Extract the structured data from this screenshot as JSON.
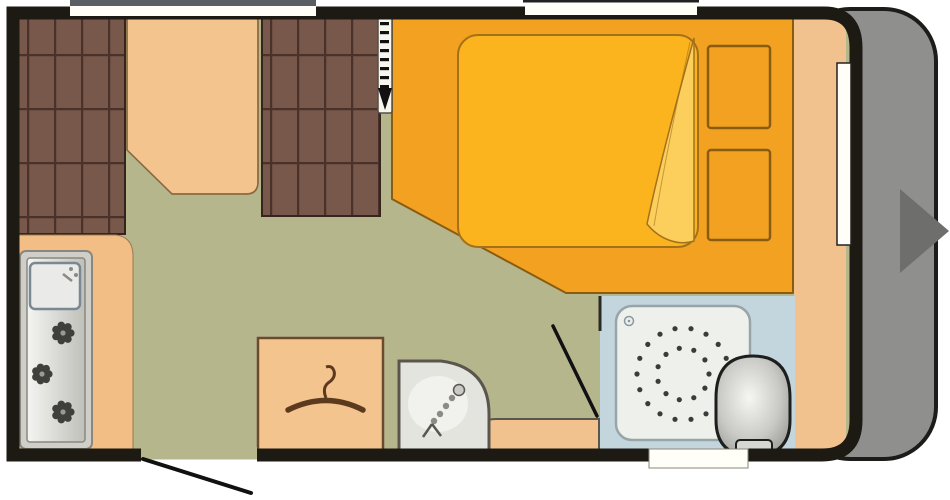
{
  "title": "Caravan floor plan (top view)",
  "fixtures": [
    "left bench seat",
    "dining table",
    "right bench seat",
    "sliding divider with arrow",
    "kitchen unit with sink and 3-burner hob",
    "double bed with folded duvet",
    "overbed storage shelves",
    "wardrobe with clothes hanger",
    "corner washbasin",
    "bathroom with shower tray and toilet",
    "entrance door with swing",
    "windows",
    "front end cap with towing direction arrow"
  ],
  "colors": {
    "page_bg": "#ffffff",
    "wall": "#1d1a14",
    "floor": "#b6b68d",
    "seat_cushion": "#77584a",
    "seat_grid": "#4a322a",
    "seat_outline": "#35251e",
    "table": "#f4c48f",
    "table_outline": "#8a6a42",
    "kitchen_counter": "#f2be85",
    "counter_outline": "#9a7a50",
    "unit_frame": "#cfcec8",
    "unit_frame_border": "#88887e",
    "unit_panel_light": "#f4f4f2",
    "unit_panel_dark": "#c0c0ba",
    "sink": "#eaeae8",
    "sink_border": "#7a8894",
    "faucet": "#8a8a86",
    "burner": "#3f3f3b",
    "burner_center": "#9a9a94",
    "bed_base": "#f2a120",
    "bed_outline": "#8a5c12",
    "mattress": "#fbb41e",
    "mattress_outline": "#a4711a",
    "fold": "#fccf5c",
    "divider_strip": "#f7f7ee",
    "divider_border": "#55504a",
    "divider_marks": "#111111",
    "bath_floor": "#c3d6de",
    "shower_tray": "#edf0eb",
    "shower_tray_border": "#98a5a8",
    "shower_dots": "#3b3b39",
    "drain": "#8a98a2",
    "toilet_light": "#f6f6f4",
    "toilet_mid": "#c9c9c5",
    "toilet_dark": "#8e8e8a",
    "toilet_outline": "#1e1e1e",
    "toilet_hinge": "#d6d6d2",
    "basin": "#e4e4de",
    "basin_border": "#5a564e",
    "basin_highlight": "#f6f6f2",
    "step": "#f2c28e",
    "wardrobe": "#f4c48f",
    "wardrobe_border": "#6b4a2f",
    "hanger": "#5c3a1e",
    "side_shelf": "#f2c28e",
    "front_cap": "#8f8f8d",
    "cap_outline": "#1c1c1a",
    "arrow": "#6e6e6c",
    "arrow_outline": "#ececea",
    "window": "#fffef7",
    "window_frame_gray": "#5a5f63",
    "window_frame_dark": "#222222",
    "door_line": "#111111",
    "partition": "#2a2a26"
  },
  "shower_rings": {
    "cx": 683,
    "cy": 374,
    "rings": [
      {
        "r": 46,
        "count": 18
      },
      {
        "r": 26,
        "count": 11
      }
    ],
    "dot_r": 2.6
  },
  "divider_dashes": {
    "x": 380,
    "w": 9,
    "h": 3.2,
    "y_start": 22,
    "step": 9,
    "count": 8
  }
}
